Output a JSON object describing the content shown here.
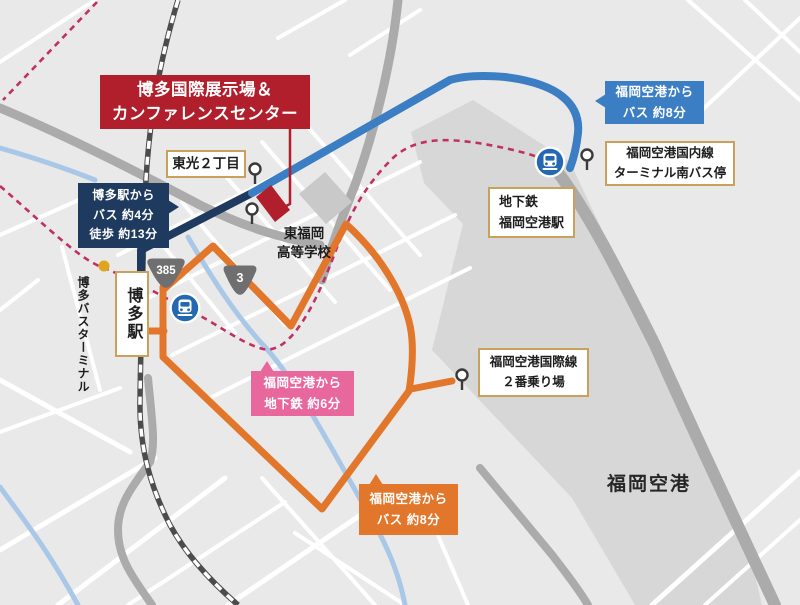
{
  "venue": {
    "name_line1": "博多国際展示場＆",
    "name_line2": "カンファレンスセンター"
  },
  "places": {
    "toko": "東光２丁目",
    "school_line1": "東福岡",
    "school_line2": "高等学校",
    "hakata_station": "博多駅",
    "hakata_bus_terminal": "博多バスターミナル",
    "subway_station_line1": "地下鉄",
    "subway_station_line2": "福岡空港駅",
    "domestic_stop_line1": "福岡空港国内線",
    "domestic_stop_line2": "ターミナル南バス停",
    "intl_stop_line1": "福岡空港国際線",
    "intl_stop_line2": "２番乗り場",
    "airport": "福岡空港"
  },
  "routes": {
    "from_hakata_line1": "博多駅から",
    "from_hakata_line2": "バス 約4分",
    "from_hakata_line3": "徒歩 約13分",
    "domestic_bus_line1": "福岡空港から",
    "domestic_bus_line2": "バス 約8分",
    "subway_line1": "福岡空港から",
    "subway_line2": "地下鉄 約6分",
    "intl_bus_line1": "福岡空港から",
    "intl_bus_line2": "バス 約8分"
  },
  "road_shields": {
    "route385": "385",
    "route3": "3"
  },
  "colors": {
    "map_background": "#e9e9e9",
    "airport_area": "#d7d7d7",
    "route_navy": "#1e3a5f",
    "route_blue": "#3c7ec3",
    "route_orange": "#e2762a",
    "subway_dashed": "#c23060",
    "venue_red": "#b01f2b",
    "bubble_pink": "#e8679d",
    "box_border_gold": "#c9a05c",
    "river_blue": "#a9c7e6",
    "bus_terminal_dot": "#dfa61d",
    "train_icon_blue": "#2368b0"
  }
}
